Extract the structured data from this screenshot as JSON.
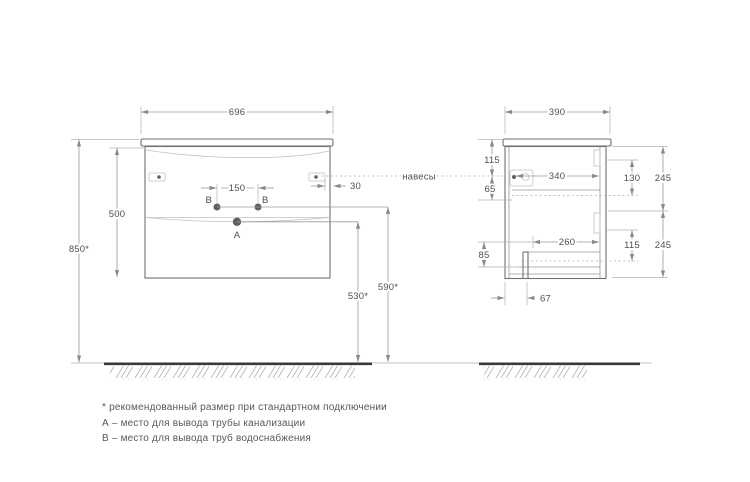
{
  "colors": {
    "line": "#9a9a9a",
    "outline": "#6f6f6f",
    "ground": "#3a3a3a",
    "text": "#4f4f4f"
  },
  "views": {
    "front": {
      "width": "696",
      "body_height": "500",
      "total_height": "850*",
      "pipe_spacing": "150",
      "hanger_side_offset": "30",
      "sewer_outlet_height": "530*",
      "water_outlet_height": "590*",
      "sewer_label": "А",
      "water_label": "В"
    },
    "side": {
      "depth": "390",
      "hanger_top_offset": "115",
      "hanger_rail_gap": "65",
      "top_drawer_depth": "340",
      "top_rail_drop": "130",
      "top_front_height": "245",
      "bottom_drawer_depth": "260",
      "bottom_rail_drop": "115",
      "bottom_front_height": "245",
      "bottom_gap": "85",
      "leg_offset": "67"
    }
  },
  "labels": {
    "hangers": "навесы"
  },
  "footnotes": [
    "* рекомендованный размер при стандартном подключении",
    "А – место для вывода трубы канализации",
    "В – место для вывода труб водоснабжения"
  ]
}
